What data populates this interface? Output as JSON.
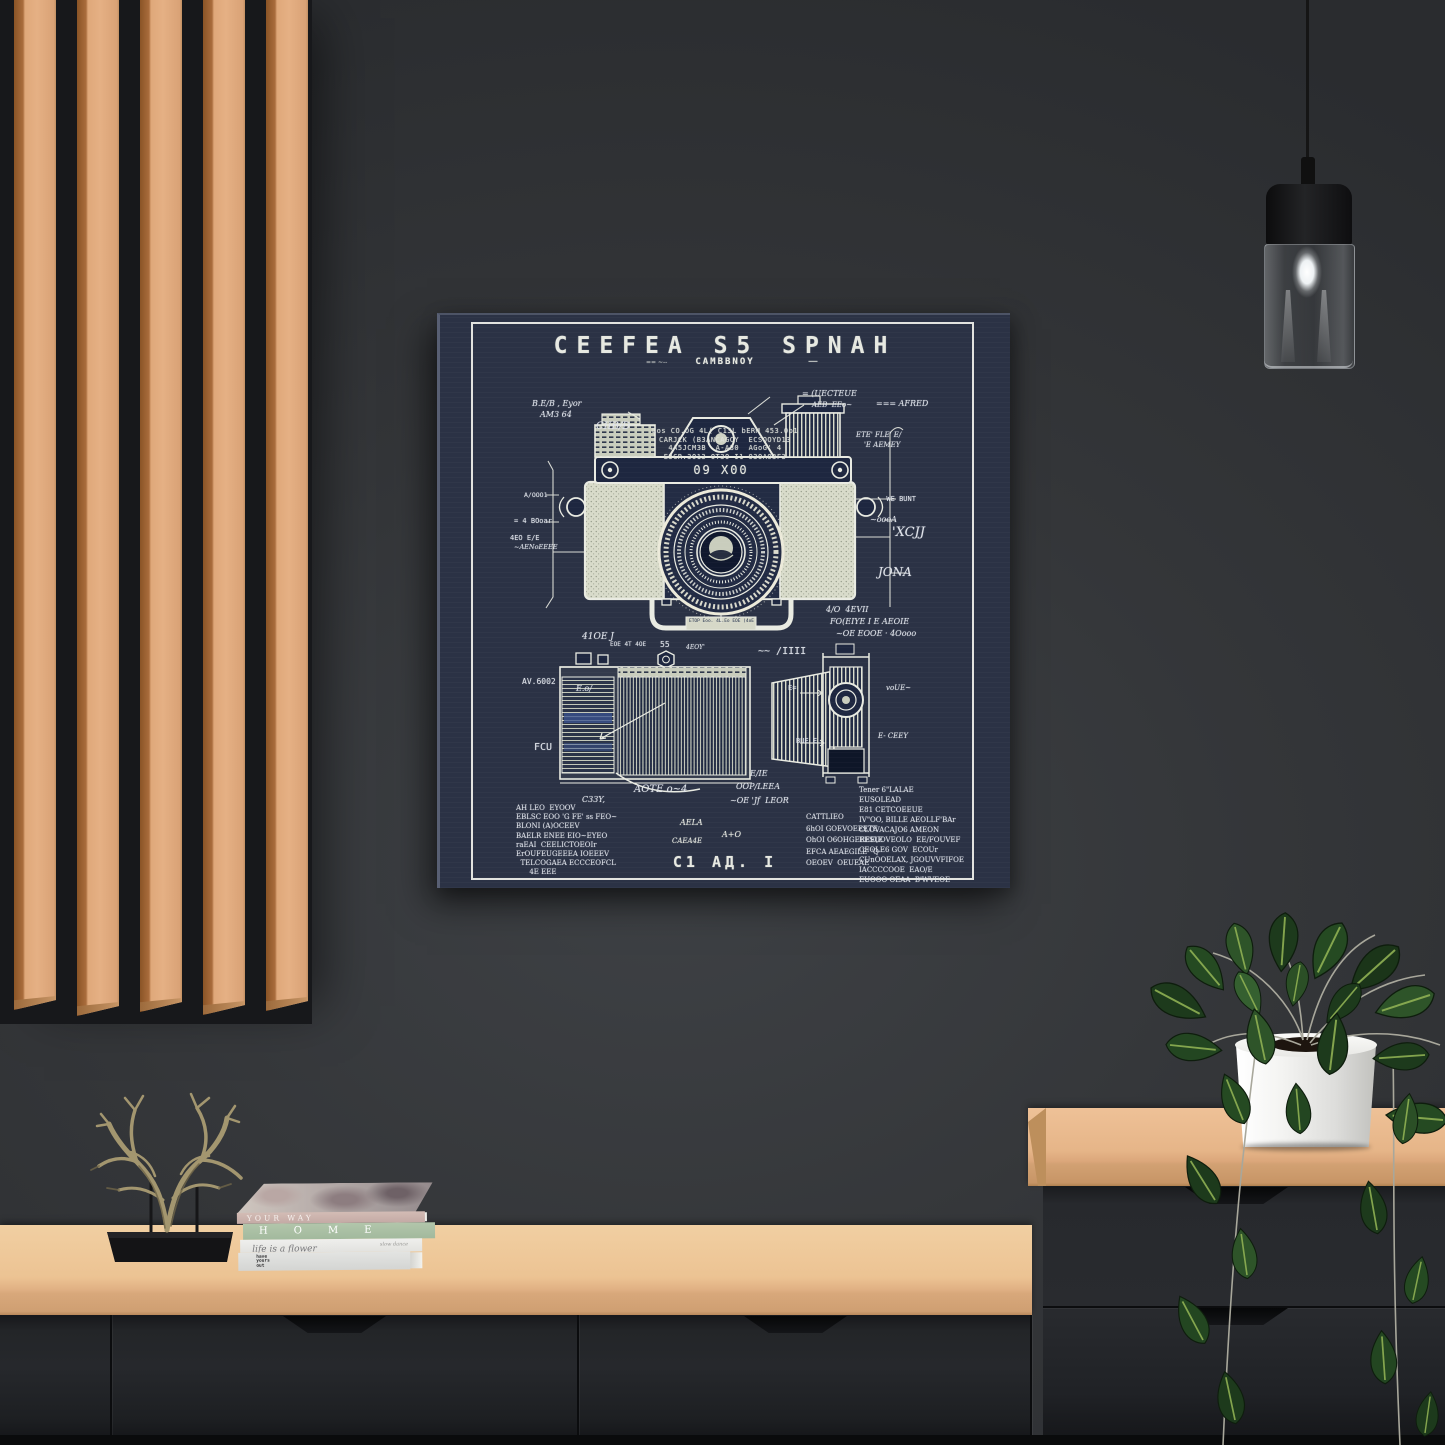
{
  "poster": {
    "title": "CEEFEA S5 SPNAH",
    "ticks": "== ~--",
    "subtitle": "CAMBBNOY",
    "dash": "—",
    "spec_lines": [
      "Los CO.OG 4L( C13L bERM 453.0o1",
      "CARJCK (B3ANCAGCY  ECSOOYD13",
      "4A5JCM3B  A-A30  AGoG' 4",
      "E3CR.3O13 OT3O I1 O3OAO3F3"
    ],
    "top_plate_label": "09 X00",
    "bracket_label": "ETOP Eoo. 4L.Eo EOE (4oE",
    "annotations": [
      {
        "text": "B.E/B , Eyor",
        "x": 92,
        "y": 84,
        "s": 8,
        "style": "cursive"
      },
      {
        "text": "AM3 64",
        "x": 100,
        "y": 95,
        "s": 8,
        "style": "cursive"
      },
      {
        "text": "CIIB/D",
        "x": 156,
        "y": 106,
        "s": 10,
        "style": "cursive"
      },
      {
        "text": "= (UECTEUE",
        "x": 362,
        "y": 74,
        "s": 8,
        "style": "cursive"
      },
      {
        "text": "AEB  EEo~",
        "x": 372,
        "y": 86,
        "s": 7,
        "style": "cursive"
      },
      {
        "text": "=== AFRED",
        "x": 436,
        "y": 84,
        "s": 8,
        "style": "cursive"
      },
      {
        "text": "ETE' FLE' E/",
        "x": 416,
        "y": 116,
        "s": 7,
        "style": "cursive"
      },
      {
        "text": "'E AEMEY",
        "x": 424,
        "y": 126,
        "s": 7,
        "style": "cursive"
      },
      {
        "text": "A/OOO1",
        "x": 84,
        "y": 176,
        "s": 6.5
      },
      {
        "text": "= 4 BOoar",
        "x": 74,
        "y": 202,
        "s": 7
      },
      {
        "text": "4EO E/E",
        "x": 70,
        "y": 219,
        "s": 7
      },
      {
        "text": "~AENoEEEE",
        "x": 74,
        "y": 228,
        "s": 6.5,
        "style": "cursive"
      },
      {
        "text": "- WE BUNT",
        "x": 438,
        "y": 180,
        "s": 7
      },
      {
        "text": "~oooA",
        "x": 430,
        "y": 200,
        "s": 8,
        "style": "cursive"
      },
      {
        "text": "'XCJJ",
        "x": 452,
        "y": 210,
        "s": 13,
        "style": "cursive"
      },
      {
        "text": "JONA",
        "x": 438,
        "y": 250,
        "s": 12,
        "style": "cursive"
      },
      {
        "text": "4/O  4EVII",
        "x": 386,
        "y": 290,
        "s": 8,
        "style": "cursive"
      },
      {
        "text": "FO(EIYE I E AEOIE",
        "x": 390,
        "y": 302,
        "s": 8,
        "style": "cursive"
      },
      {
        "text": "~OE EOOE · 4Oooo",
        "x": 396,
        "y": 314,
        "s": 8,
        "style": "cursive"
      },
      {
        "text": "41OE J",
        "x": 142,
        "y": 317,
        "s": 9,
        "style": "cursive"
      },
      {
        "text": "EOE 4T 4OE",
        "x": 170,
        "y": 326,
        "s": 6
      },
      {
        "text": "55",
        "x": 220,
        "y": 325,
        "s": 8
      },
      {
        "text": "4EOY'",
        "x": 246,
        "y": 329,
        "s": 6,
        "style": "cursive"
      },
      {
        "text": "~~ /IIII",
        "x": 318,
        "y": 331,
        "s": 10
      },
      {
        "text": "AV.6002",
        "x": 82,
        "y": 362,
        "s": 8
      },
      {
        "text": "E.o/",
        "x": 136,
        "y": 369,
        "s": 8,
        "style": "cursive"
      },
      {
        "text": "FCU",
        "x": 94,
        "y": 427,
        "s": 10
      },
      {
        "text": "AOTE o~4",
        "x": 194,
        "y": 469,
        "s": 10,
        "style": "cursive"
      },
      {
        "text": "C33Y,",
        "x": 142,
        "y": 480,
        "s": 8,
        "style": "cursive"
      },
      {
        "text": "E/IE",
        "x": 310,
        "y": 454,
        "s": 8,
        "style": "cursive"
      },
      {
        "text": "OOP/LEEA",
        "x": 296,
        "y": 467,
        "s": 8,
        "style": "cursive"
      },
      {
        "text": "~OE 'Jf  LEOR",
        "x": 290,
        "y": 481,
        "s": 8,
        "style": "cursive"
      },
      {
        "text": "voUE~",
        "x": 446,
        "y": 369,
        "s": 7,
        "style": "cursive"
      },
      {
        "text": "E- CEEY",
        "x": 438,
        "y": 417,
        "s": 7,
        "style": "cursive"
      },
      {
        "text": "BUE E",
        "x": 356,
        "y": 422,
        "s": 7
      },
      {
        "text": "E=",
        "x": 348,
        "y": 369,
        "s": 7
      }
    ],
    "footer_left": [
      "AH LEO  EYOOV",
      "EBLSC EOO 'G FE' ss FEO~",
      "BLONI (A)OCEEV",
      "BAELR ENEE EIO~EYEO",
      "raEAI  CEELICTOEOIr",
      "ErOUFEUGEEEA IOEEEV",
      "  TELCOGAEA ECCCEOFCL",
      "      4E EEE"
    ],
    "footer_center": {
      "a": "AELA",
      "b": "A+O",
      "c": "CAEA4E",
      "mark": "C1 AД. I"
    },
    "footer_mid": [
      "CATTLIEO",
      "6hOI GOEVOEEETE",
      "OhOI O6OHGEREE(E",
      "EFCA AEAEGILE' 'Q",
      "OEOEV  OEUEAE"
    ],
    "footer_right": [
      "Tener 6\"LALAE",
      "EUSOLEAD",
      "E81 CETCOEEUE",
      "IV\"OO, BILLE AEOLLF'BAr",
      "CLOVACAJO6 AMEON",
      "EESUOVEOLO  EE/FOUVEF",
      "CEOLE6 GOV  ECOUr",
      "CUnOOELAX, JGOUVVFIFOE",
      "IACCCCOOE  EAO/E",
      "EUOOO OEAA  B'WVEOE"
    ],
    "colors": {
      "canvas": "#2b3245",
      "ink": "#e7e9e2"
    }
  },
  "books": [
    {
      "spine": "YOUR WAY"
    },
    {
      "spine": "HOME"
    },
    {
      "spine": "life is a flower",
      "note": "slow dance"
    },
    {
      "spine": "have\nyours\nout"
    }
  ],
  "scene_colors": {
    "wall": "#343639",
    "slat_wood": "#e0ab7e",
    "counter_wood": "#ecc393",
    "cabinet": "#26282c",
    "plant_leaf": "#24431f",
    "pot": "#f2f2f0"
  }
}
